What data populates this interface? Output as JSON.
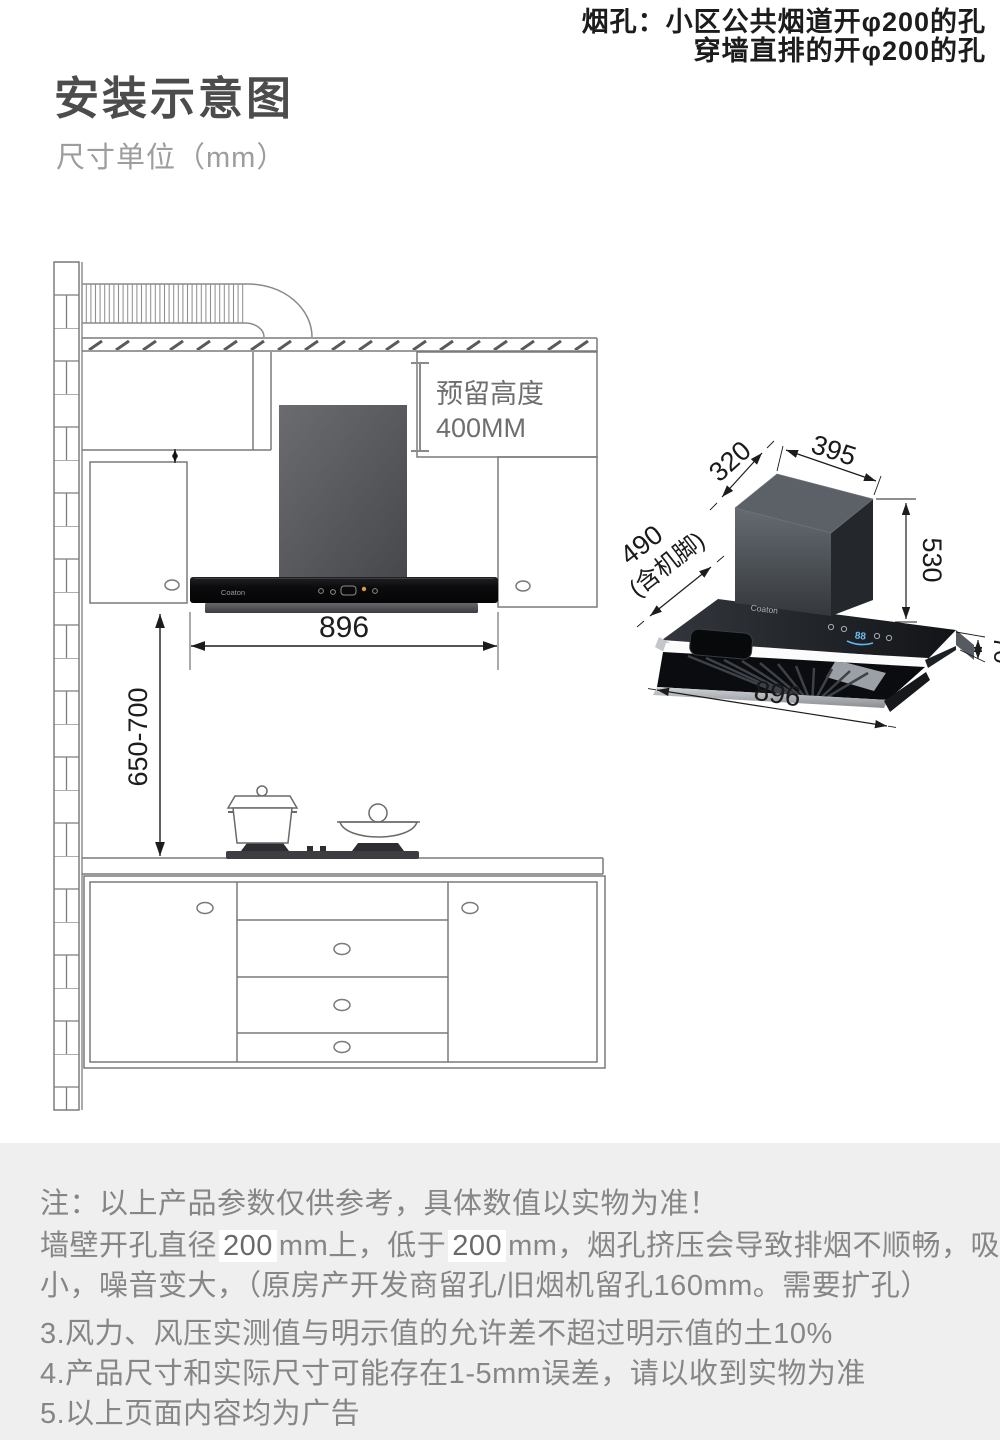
{
  "top_note": {
    "line1": "烟孔：小区公共烟道开φ200的孔",
    "line2": "穿墙直排的开φ200的孔"
  },
  "header": {
    "title": "安装示意图",
    "unit_label": "尺寸单位（mm）"
  },
  "diagram": {
    "reserved_height_line1": "预留高度",
    "reserved_height_line2": "400MM",
    "hood_width": "896",
    "install_height_range": "650-700",
    "brand_logo": "Coaton"
  },
  "hood_3d": {
    "depth": "320",
    "top_width": "395",
    "chimney_height": "530",
    "total_height": "490",
    "total_height_note": "(含机脚)",
    "body_height": "70",
    "width": "896",
    "brand_logo": "Coaton",
    "display_value": "88"
  },
  "notes": {
    "line1": "注：以上产品参数仅供参考，具体数值以实物为准！",
    "line2_part1": "墙壁开孔直径",
    "line2_hl1": "200",
    "line2_part2": "mm上，低于",
    "line2_hl2": "200",
    "line2_part3": "mm，烟孔挤压会导致排烟不顺畅，吸力变",
    "line3": "小，噪音变大，（原房产开发商留孔/旧烟机留孔160mm。需要扩孔）",
    "line4": "3.风力、风压实测值与明示值的允许差不超过明示值的土10%",
    "line5": "4.产品尺寸和实际尺寸可能存在1-5mm误差，请以收到实物为准",
    "line6": "5.以上页面内容均为广告"
  },
  "colors": {
    "accent_blue": "#66bdf2",
    "note_gray": "#868686",
    "line_gray": "#7a7a7a",
    "dark_text": "#1c1c1c",
    "panel_gray": "#efefef"
  }
}
